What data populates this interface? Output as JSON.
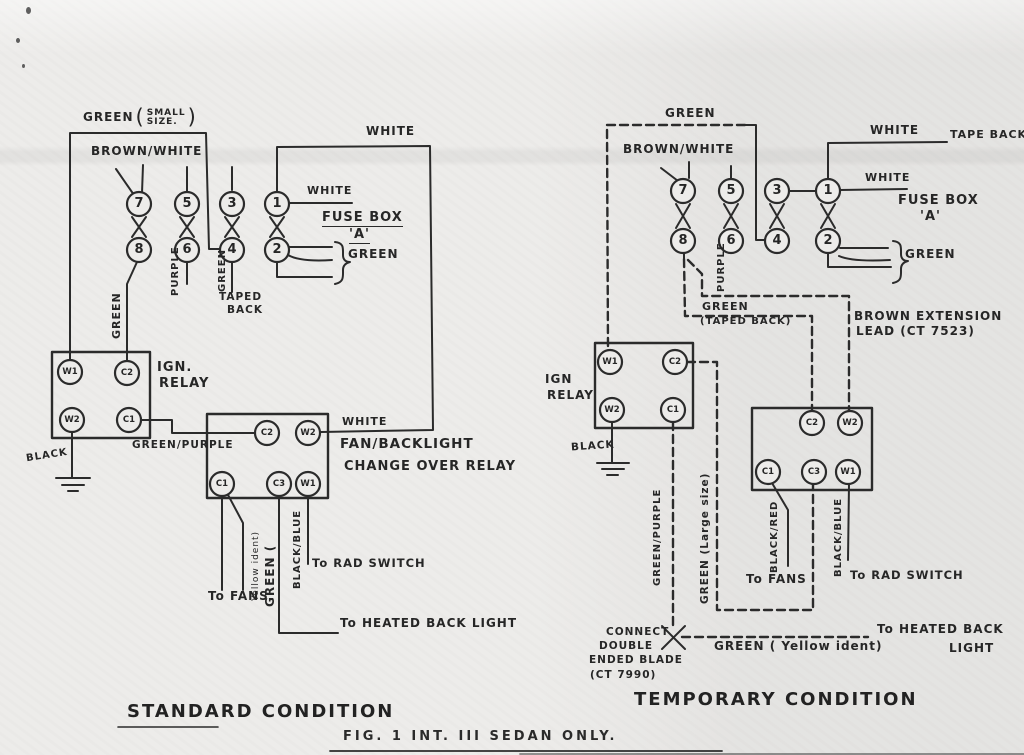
{
  "figure": {
    "caption": "FIG. 1 INT. III SEDAN ONLY.",
    "ink": "#2b2b2b",
    "paper": "#edecea"
  },
  "standard": {
    "title": "STANDARD CONDITION",
    "fuses": [
      "7",
      "8",
      "5",
      "6",
      "3",
      "4",
      "1",
      "2"
    ],
    "ign": {
      "line1": "IGN.",
      "line2": "RELAY",
      "t": [
        "W1",
        "C2",
        "W2",
        "C1"
      ]
    },
    "chg": {
      "line1": "FAN/BACKLIGHT",
      "line2": "CHANGE OVER RELAY",
      "t": [
        "C2",
        "W2",
        "C1",
        "C3",
        "W1"
      ]
    },
    "labels": {
      "green_feed": "GREEN",
      "paren_l": "(",
      "paren_r": ")",
      "note1": "SMALL",
      "note2": "SIZE.",
      "brown_white": "BROWN/WHITE",
      "purple": "PURPLE",
      "green_f4": "GREEN",
      "taped1": "TAPED",
      "taped2": "BACK",
      "white_top": "WHITE",
      "white_f1": "WHITE",
      "white_w2": "WHITE",
      "fusebox1": "FUSE BOX",
      "fusebox2": "'A'",
      "green_bracket": "GREEN",
      "green_f8": "GREEN",
      "black": "BLACK",
      "green_purple": "GREEN/PURPLE",
      "green_yel1": "GREEN (",
      "green_yel2": "Yellow ident)",
      "black_blue": "BLACK/BLUE",
      "to_fans": "To FANS",
      "to_rad": "To RAD SWITCH",
      "to_heated": "To HEATED BACK LIGHT"
    }
  },
  "temporary": {
    "title": "TEMPORARY CONDITION",
    "fuses": [
      "7",
      "8",
      "5",
      "6",
      "3",
      "4",
      "1",
      "2"
    ],
    "ign": {
      "line1": "IGN",
      "line2": "RELAY",
      "t": [
        "W1",
        "C2",
        "W2",
        "C1"
      ]
    },
    "chg": {
      "t": [
        "C2",
        "W2",
        "C1",
        "C3",
        "W1"
      ]
    },
    "labels": {
      "green_top": "GREEN",
      "brown_white": "BROWN/WHITE",
      "purple": "PURPLE",
      "white_tape": "WHITE",
      "tape_back": "TAPE BACK",
      "white_f1": "WHITE",
      "fusebox1": "FUSE BOX",
      "fusebox2": "'A'",
      "green_bracket": "GREEN",
      "green_taped1": "GREEN",
      "green_taped2": "(TAPED BACK)",
      "brown_ext1": "BROWN EXTENSION",
      "brown_ext2": "LEAD (CT 7523)",
      "black": "BLACK",
      "green_purple": "GREEN/PURPLE",
      "green_large": "GREEN (Large size)",
      "black_red": "BLACK/RED",
      "black_blue": "BLACK/BLUE",
      "to_fans": "To FANS",
      "to_rad": "To RAD SWITCH",
      "connect1": "CONNECT",
      "connect2": "DOUBLE",
      "connect3": "ENDED BLADE",
      "connect4": "(CT 7990)",
      "green_yellow": "GREEN ( Yellow ident)",
      "to_heated1": "To HEATED BACK",
      "to_heated2": "LIGHT"
    }
  }
}
